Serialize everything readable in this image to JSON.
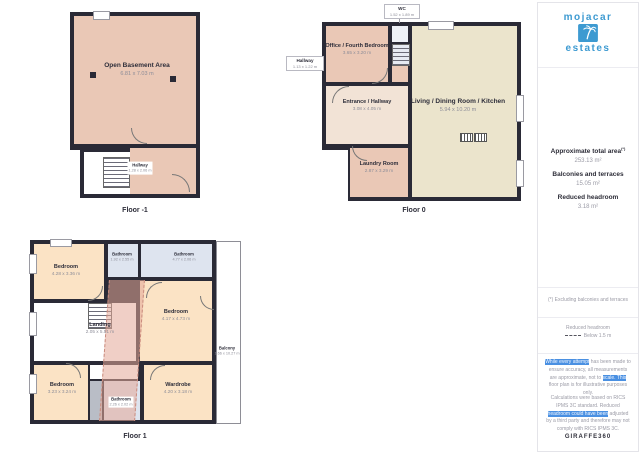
{
  "floors": [
    {
      "label": "Floor -1",
      "rooms": [
        {
          "name": "Open Basement Area",
          "dims": "6.81 x 7.03 m"
        },
        {
          "name": "Hallway",
          "dims": "1.28 x 2.06 m"
        }
      ]
    },
    {
      "label": "Floor 0",
      "rooms": [
        {
          "name": "WC",
          "dims": "1.52 x 1.89 m"
        },
        {
          "name": "Hallway",
          "dims": "1.13 x 1.22 m"
        },
        {
          "name": "Office / Fourth Bedroom",
          "dims": "3.65 x 3.20 m"
        },
        {
          "name": "Entrance / Hallway",
          "dims": "3.08 x 4.05 m"
        },
        {
          "name": "Living / Dining Room / Kitchen",
          "dims": "5.94 x 10.20 m"
        },
        {
          "name": "Laundry Room",
          "dims": "2.87 x 3.29 m"
        }
      ]
    },
    {
      "label": "Floor 1",
      "rooms": [
        {
          "name": "Bedroom",
          "dims": "4.28 x 3.36 m"
        },
        {
          "name": "Bathroom",
          "dims": "1.92 x 2.55 m"
        },
        {
          "name": "Bathroom",
          "dims": "4.77 x 2.06 m"
        },
        {
          "name": "Bedroom",
          "dims": "4.17 x 4.73 m"
        },
        {
          "name": "Landing",
          "dims": "2.05 x 5.51 m"
        },
        {
          "name": "Bedroom",
          "dims": "3.23 x 3.24 m"
        },
        {
          "name": "Bathroom",
          "dims": "2.26 x 2.02 m"
        },
        {
          "name": "Wardrobe",
          "dims": "4.20 x 3.18 m"
        },
        {
          "name": "Balcony",
          "dims": "1.66 x 10.27 m"
        }
      ]
    }
  ],
  "sidebar": {
    "logo": {
      "word1": "mojacar",
      "word2": "estates",
      "icon": "palm-tree"
    },
    "stats": [
      {
        "label": "Approximate total area",
        "sup": "(*)",
        "value": "253.13 m²"
      },
      {
        "label": "Balconies and terraces",
        "sup": "",
        "value": "15.05 m²"
      },
      {
        "label": "Reduced headroom",
        "sup": "",
        "value": "3.18 m²"
      }
    ],
    "footnote": "(*) Excluding balconies and terraces",
    "legend": {
      "title": "Reduced headroom",
      "item": "Below 1.5 m"
    },
    "disclaimer1": [
      {
        "t": "While every attempt",
        "hl": true
      },
      {
        "t": " has been made to ensure accuracy, all measurements are approximate, not to ",
        "hl": false
      },
      {
        "t": "scale. This",
        "hl": true
      },
      {
        "t": " floor plan is for illustrative purposes only.",
        "hl": false
      }
    ],
    "disclaimer2": [
      {
        "t": "Calculations were based on RICS IPMS 3C standard. Reduced ",
        "hl": false
      },
      {
        "t": "headroom could have been",
        "hl": true
      },
      {
        "t": " adjusted by a third party and therefore may not comply with RICS IPMS 3C.",
        "hl": false
      }
    ],
    "brand": "GIRAFFE360"
  },
  "colors": {
    "wall": "#2a2a36",
    "salmon": "#eac8b6",
    "peach": "#fbe3c5",
    "beige": "#ebe4cc",
    "entrance": "#f2e3d6",
    "bath_blue": "#dee4ef",
    "brand_blue": "#3d9ad1",
    "highlight": "#4a90e2"
  }
}
